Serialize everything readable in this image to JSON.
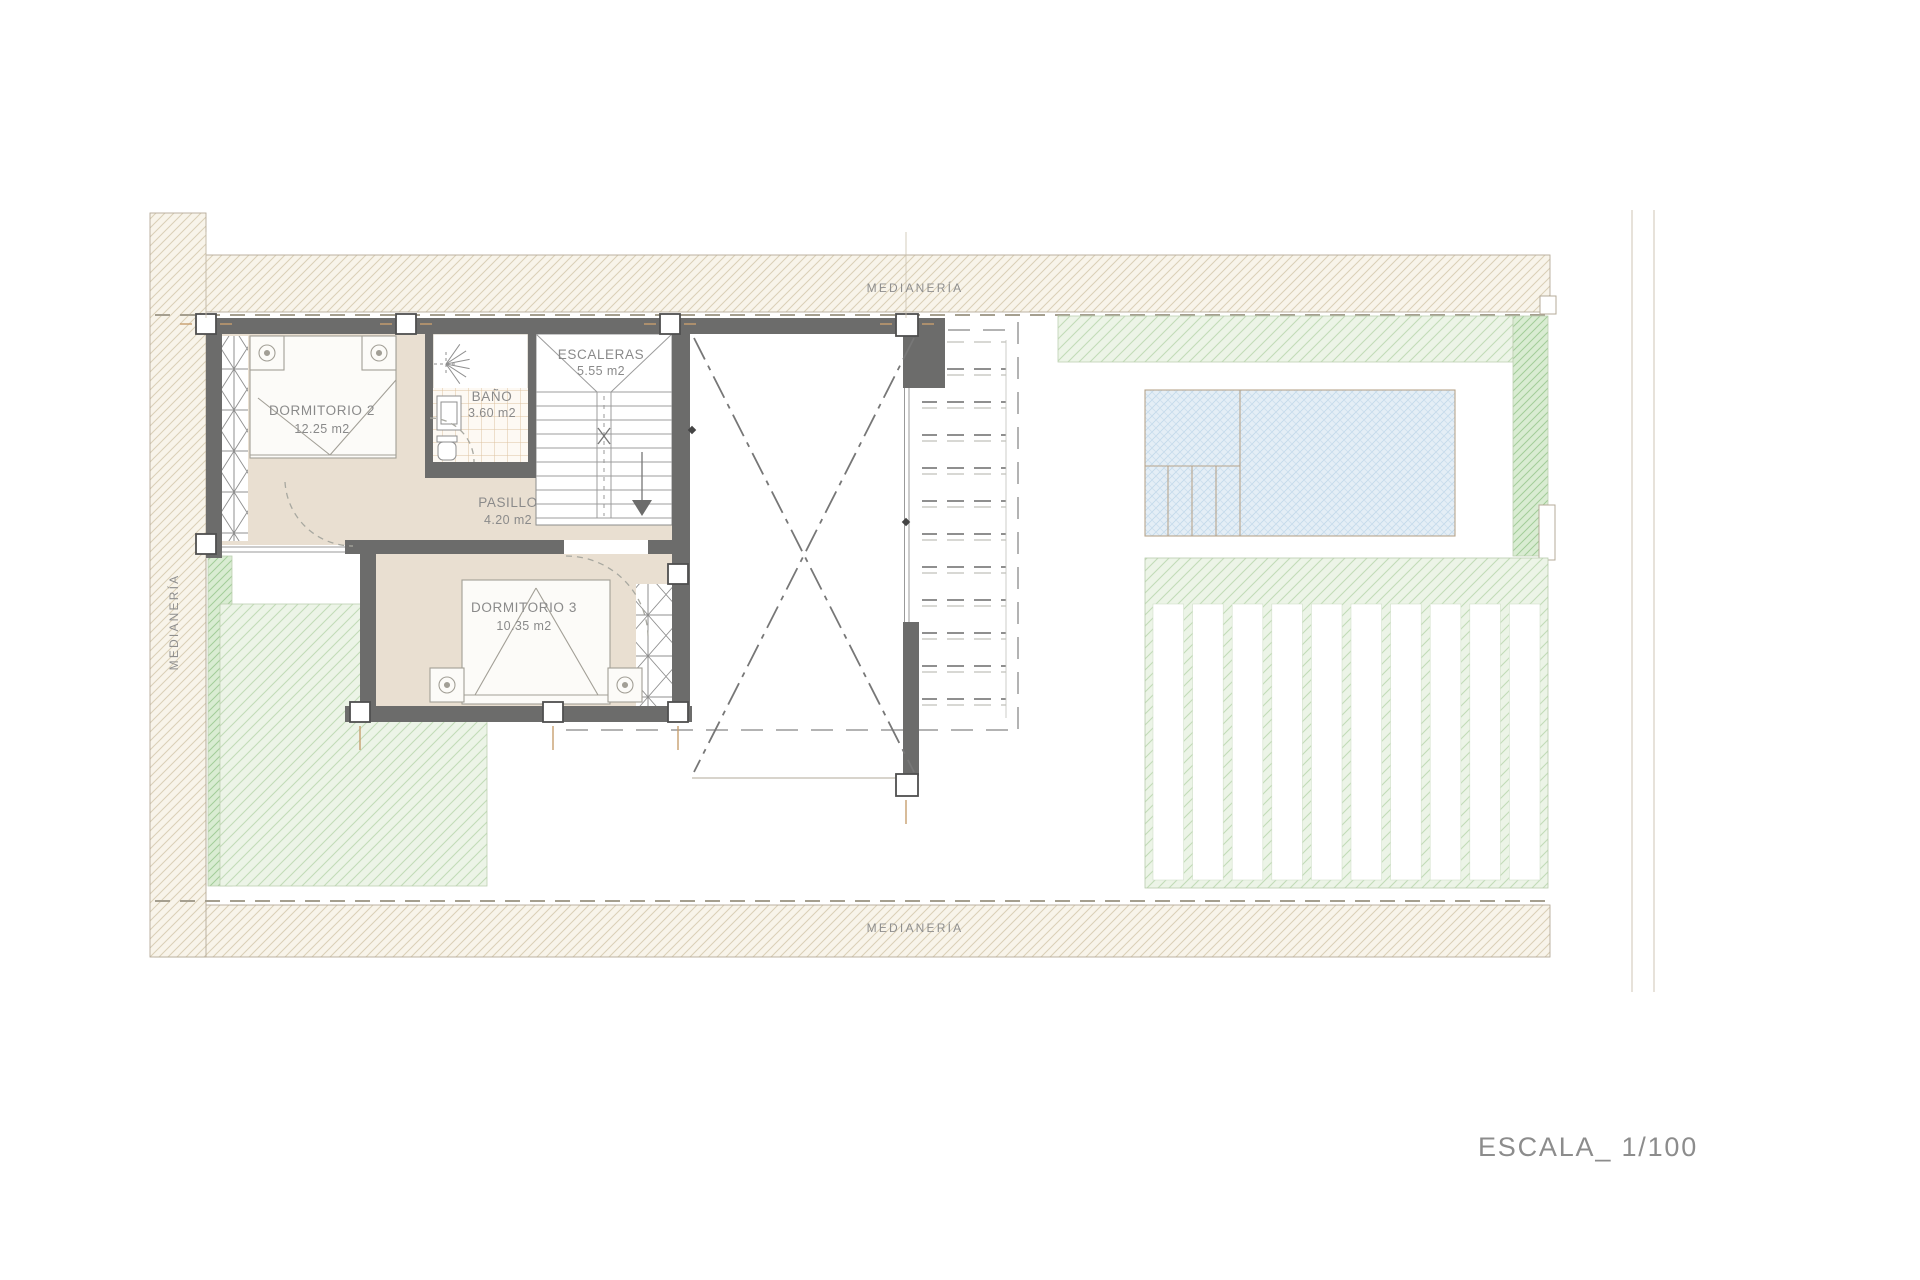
{
  "palette": {
    "wall": "#6c6c6b",
    "floor_beige": "#e9dfd1",
    "party_hatch_line": "#dacfb6",
    "green_light": "#c2dcb8",
    "green_dark": "#a3cd99",
    "pool_blue": "#c1d8ea",
    "tile_line": "#ddc2a0",
    "text_gray": "#8a8a8a"
  },
  "labels": {
    "party_wall_top": "MEDIANERÍA",
    "party_wall_bottom": "MEDIANERÍA",
    "party_wall_left": "MEDIANERÍA",
    "scale": "ESCALA_ 1/100"
  },
  "rooms": {
    "dormitorio2": {
      "name": "DORMITORIO 2",
      "area": "12.25 m2"
    },
    "bano": {
      "name": "BAÑO",
      "area": "3.60 m2"
    },
    "escaleras": {
      "name": "ESCALERAS",
      "area": "5.55 m2"
    },
    "pasillo": {
      "name": "PASILLO",
      "area": "4.20 m2"
    },
    "dormitorio3": {
      "name": "DORMITORIO 3",
      "area": "10.35 m2"
    }
  }
}
